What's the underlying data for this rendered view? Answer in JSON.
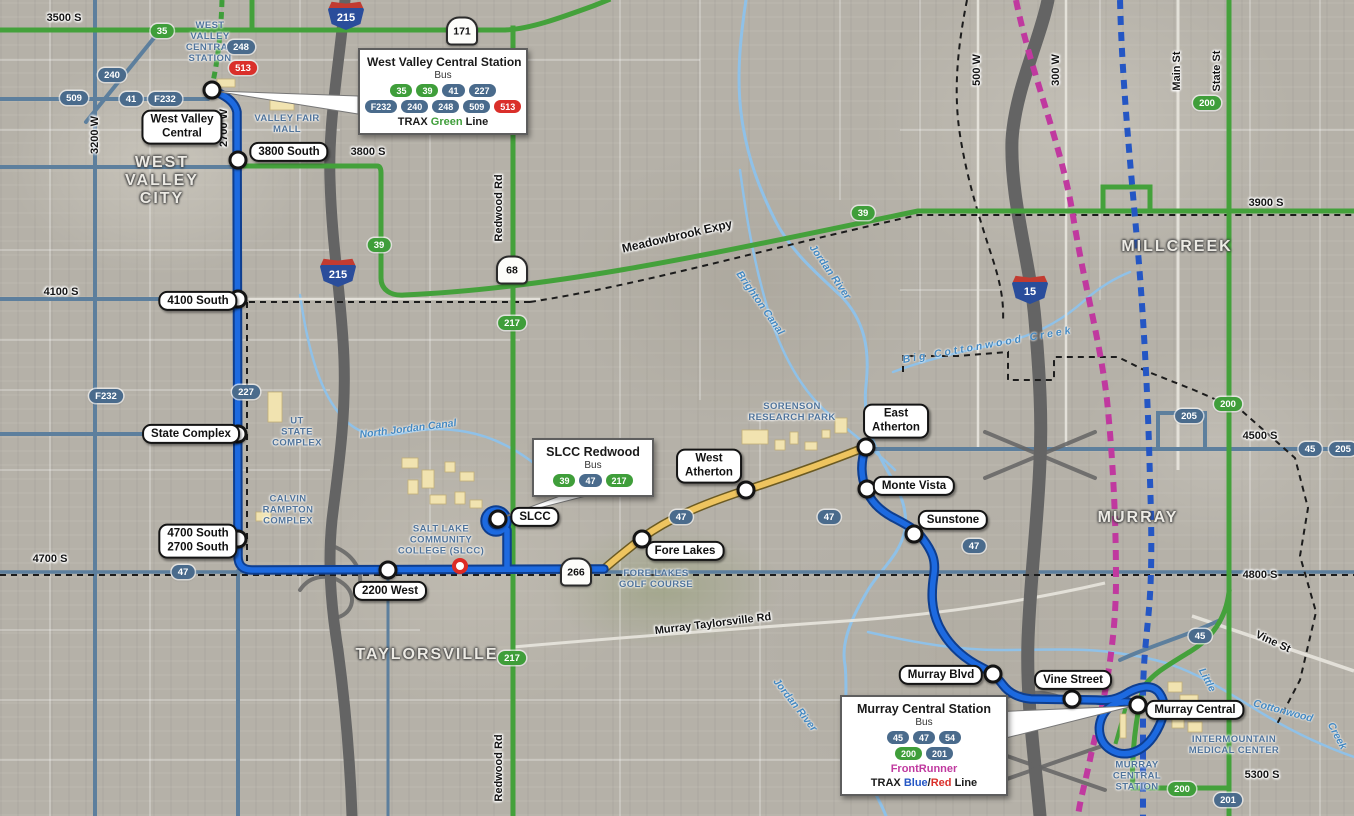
{
  "colors": {
    "route_blue": "#1d6ae0",
    "route_green": "#44a13b",
    "badge_green": "#3f9e3a",
    "badge_slate": "#4a6b8c",
    "badge_red": "#da2f2a",
    "frontrunner_magenta": "#c0399f",
    "trax_blue": "#2456c4",
    "construction_yellow": "#eec45f",
    "water_blue": "#8fc1e8"
  },
  "callouts": {
    "west_valley": {
      "title": "West Valley Central Station",
      "bus_label": "Bus",
      "row1": [
        "35",
        "39",
        "41",
        "227"
      ],
      "row2": [
        "F232",
        "240",
        "248",
        "509",
        "513"
      ],
      "rail_prefix": "TRAX",
      "rail_line": "Green",
      "rail_suffix": "Line"
    },
    "slcc": {
      "title": "SLCC Redwood",
      "bus_label": "Bus",
      "row1": [
        "39",
        "47",
        "217"
      ]
    },
    "murray": {
      "title": "Murray Central Station",
      "bus_label": "Bus",
      "row1": [
        "45",
        "47",
        "54"
      ],
      "row2": [
        "200",
        "201"
      ],
      "frontrunner": "FrontRunner",
      "rail_prefix": "TRAX",
      "rail_blue": "Blue",
      "rail_slash": "/",
      "rail_red": "Red",
      "rail_suffix": "Line"
    }
  },
  "stops": [
    {
      "label": "West Valley\nCentral"
    },
    {
      "label": "3800 South"
    },
    {
      "label": "4100 South"
    },
    {
      "label": "State Complex"
    },
    {
      "label": "4700 South\n2700 South"
    },
    {
      "label": "2200 West"
    },
    {
      "label": "SLCC"
    },
    {
      "label": "Fore Lakes"
    },
    {
      "label": "West\nAtherton"
    },
    {
      "label": "East\nAtherton"
    },
    {
      "label": "Monte Vista"
    },
    {
      "label": "Sunstone"
    },
    {
      "label": "Murray Blvd"
    },
    {
      "label": "Vine Street"
    },
    {
      "label": "Murray Central"
    }
  ],
  "badges": [
    {
      "text": "35"
    },
    {
      "text": "248"
    },
    {
      "text": "513"
    },
    {
      "text": "240"
    },
    {
      "text": "509"
    },
    {
      "text": "41"
    },
    {
      "text": "F232"
    },
    {
      "text": "39"
    },
    {
      "text": "217"
    },
    {
      "text": "F232"
    },
    {
      "text": "227"
    },
    {
      "text": "39"
    },
    {
      "text": "200"
    },
    {
      "text": "47"
    },
    {
      "text": "47"
    },
    {
      "text": "47"
    },
    {
      "text": "47"
    },
    {
      "text": "217"
    },
    {
      "text": "205"
    },
    {
      "text": "200"
    },
    {
      "text": "45"
    },
    {
      "text": "205"
    },
    {
      "text": "45"
    },
    {
      "text": "200"
    },
    {
      "text": "201"
    }
  ],
  "shields": [
    {
      "label": "215"
    },
    {
      "label": "215"
    },
    {
      "label": "15"
    },
    {
      "label": "171"
    },
    {
      "label": "68"
    },
    {
      "label": "266"
    }
  ],
  "street_labels": [
    {
      "text": "3500 S"
    },
    {
      "text": "3200 W"
    },
    {
      "text": "2700 W"
    },
    {
      "text": "3800 S"
    },
    {
      "text": "4100 S"
    },
    {
      "text": "4700 S"
    },
    {
      "text": "Redwood Rd"
    },
    {
      "text": "Redwood Rd"
    },
    {
      "text": "Meadowbrook Expy"
    },
    {
      "text": "3900 S"
    },
    {
      "text": "500 W"
    },
    {
      "text": "300 W"
    },
    {
      "text": "Main St"
    },
    {
      "text": "State St"
    },
    {
      "text": "4500 S"
    },
    {
      "text": "Murray Taylorsville Rd"
    },
    {
      "text": "4800 S"
    },
    {
      "text": "Vine St"
    },
    {
      "text": "5300 S"
    }
  ],
  "city_labels": [
    {
      "text": "WEST\nVALLEY\nCITY"
    },
    {
      "text": "TAYLORSVILLE"
    },
    {
      "text": "MILLCREEK"
    },
    {
      "text": "MURRAY"
    }
  ],
  "area_labels": [
    {
      "text": "WEST\nVALLEY\nCENTRAL\nSTATION"
    },
    {
      "text": "VALLEY FAIR\nMALL"
    },
    {
      "text": "UT\nSTATE\nCOMPLEX"
    },
    {
      "text": "CALVIN\nRAMPTON\nCOMPLEX"
    },
    {
      "text": "SALT LAKE\nCOMMUNITY\nCOLLEGE (SLCC)"
    },
    {
      "text": "SORENSON\nRESEARCH PARK"
    },
    {
      "text": "FORE LAKES\nGOLF COURSE"
    },
    {
      "text": "INTERMOUNTAIN\nMEDICAL CENTER"
    },
    {
      "text": "MURRAY\nCENTRAL\nSTATION"
    }
  ],
  "water_labels": [
    {
      "text": "North Jordan Canal"
    },
    {
      "text": "Jordan River"
    },
    {
      "text": "Brighton Canal"
    },
    {
      "text": "Big Cottonwood Creek"
    },
    {
      "text": "Jordan River"
    },
    {
      "text": "Little"
    },
    {
      "text": "Cottonwood"
    },
    {
      "text": "Creek"
    }
  ]
}
